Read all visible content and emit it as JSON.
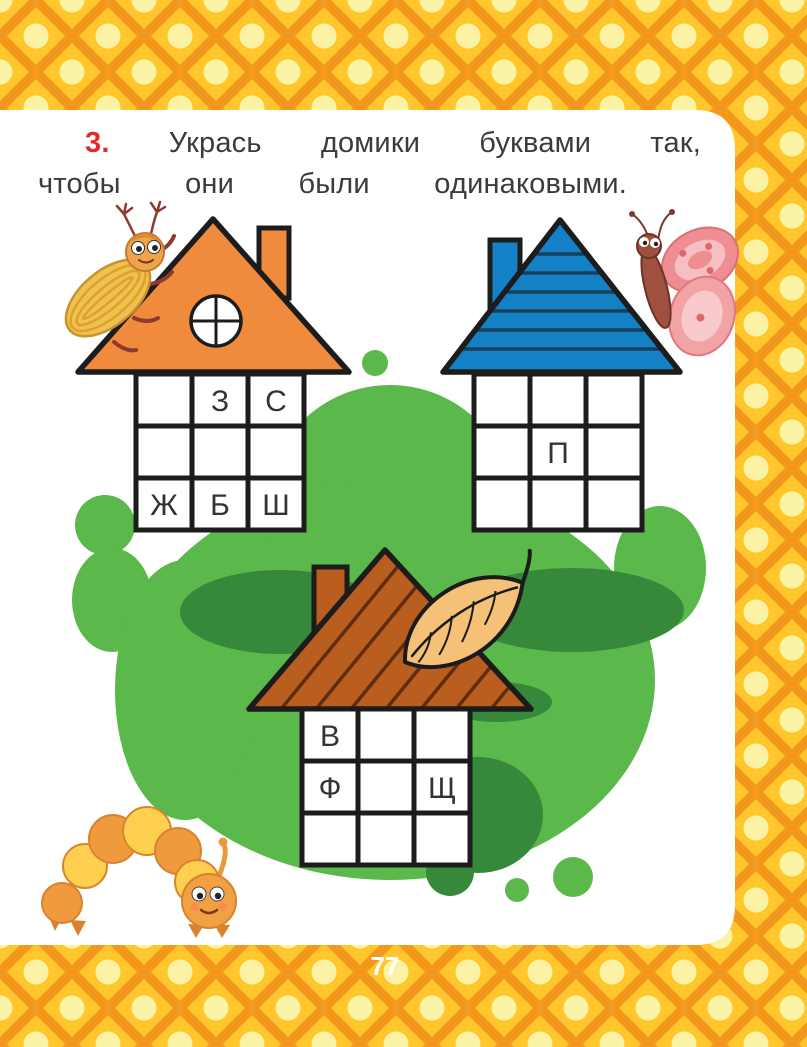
{
  "task": {
    "number": "3.",
    "line1": "Укрась домики буквами так,",
    "line2": "чтобы они были одинаковыми."
  },
  "page_number": "77",
  "houses": [
    {
      "name": "orange-house",
      "roof_color": "#F08B3D",
      "roof_style": "plain-with-round-window",
      "chimney_side": "right",
      "decoration": "beetle",
      "letters": [
        "",
        "З",
        "С",
        "",
        "",
        "",
        "Ж",
        "Б",
        "Ш"
      ]
    },
    {
      "name": "blue-house",
      "roof_color": "#1480C6",
      "roof_style": "horizontal-stripes",
      "chimney_side": "left",
      "decoration": "butterfly",
      "letters": [
        "",
        "",
        "",
        "",
        "П",
        "",
        "",
        "",
        ""
      ]
    },
    {
      "name": "brown-house",
      "roof_color": "#BA5E1F",
      "roof_style": "diagonal-planks",
      "chimney_side": "left",
      "decoration": "leaf",
      "letters": [
        "В",
        "",
        "",
        "Ф",
        "",
        "Щ",
        "",
        "",
        ""
      ]
    }
  ],
  "decorations": [
    "beetle",
    "butterfly",
    "caterpillar",
    "leaf"
  ],
  "colors": {
    "border_yellow": "#FFC62E",
    "border_orange": "#F2981D",
    "border_dot": "#FAF3A6",
    "sheet_white": "#FFFFFF",
    "grass_green": "#5BB84A",
    "grass_dark_green": "#36883B",
    "roof_orange": "#F08B3D",
    "roof_blue": "#1480C6",
    "roof_brown": "#BA5E1F",
    "outline_black": "#1C1C1C",
    "task_number_red": "#E22A2A",
    "text_gray": "#3B3B3B",
    "page_number_white": "#FFFFFF"
  }
}
